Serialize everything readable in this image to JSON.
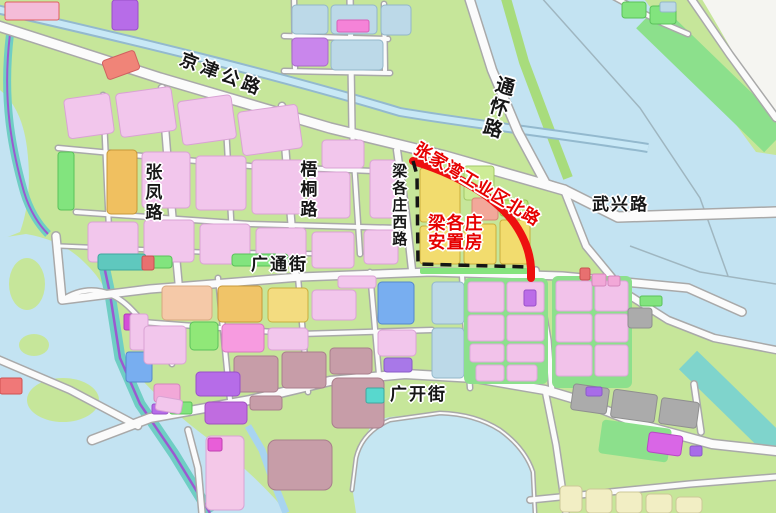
{
  "map": {
    "type": "urban-planning-zoning-map",
    "roads": [
      {
        "id": "jingjin-highway",
        "label": "京津公路",
        "label_color": "#161616",
        "orientation": "diagonal"
      },
      {
        "id": "tonghuai-road",
        "label": "通怀路",
        "label_color": "#161616",
        "orientation": "vertical"
      },
      {
        "id": "wuxing-road",
        "label": "武兴路",
        "label_color": "#161616",
        "orientation": "horizontal"
      },
      {
        "id": "zhangfeng-road",
        "label": "张凤路",
        "label_color": "#161616",
        "orientation": "vertical"
      },
      {
        "id": "wutong-road",
        "label": "梧桐路",
        "label_color": "#161616",
        "orientation": "vertical"
      },
      {
        "id": "lianggezhuang-west-road",
        "label": "梁各庄西路",
        "label_color": "#161616",
        "orientation": "vertical"
      },
      {
        "id": "guangtong-street",
        "label": "广通街",
        "label_color": "#161616",
        "orientation": "horizontal"
      },
      {
        "id": "guangkai-street",
        "label": "广开街",
        "label_color": "#161616",
        "orientation": "horizontal"
      },
      {
        "id": "zhangjiawan-industrial-north-road",
        "label": "张家湾工业区北路",
        "label_color": "#E60000",
        "orientation": "diagonal"
      }
    ],
    "highlight_zone": {
      "name_line1": "梁各庄",
      "name_line2": "安置房",
      "label_color": "#E60000",
      "boundary_solid_color": "#EE1010",
      "boundary_dashed_color": "#151515"
    },
    "colors": {
      "background_green": "#C6E69A",
      "water_blue": "#C3E3F2",
      "road_fill": "#FBFBFB",
      "road_casing": "#A9A9A9",
      "parcel_pink": "#F2C6EC",
      "parcel_yellow": "#F2DC6E",
      "parcel_green": "#82E47E",
      "parcel_bluegray": "#BCD9E8",
      "parcel_mauve": "#C79DA8",
      "parcel_gray": "#ABABAB",
      "canal_teal": "#6FCEC4",
      "canal_purple_line": "#9B59D0"
    }
  }
}
